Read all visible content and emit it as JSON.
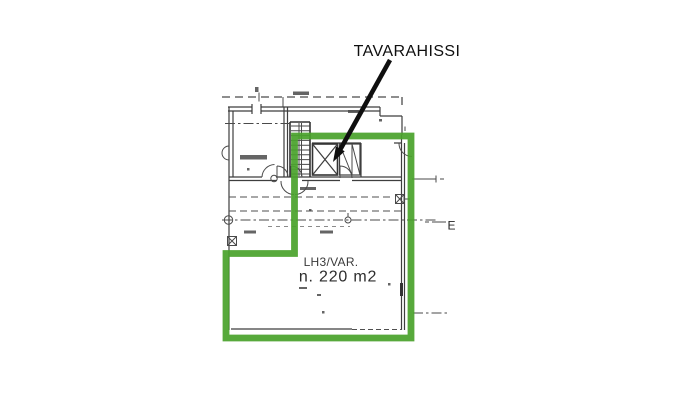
{
  "annotation": {
    "label": "TAVARAHISSI"
  },
  "area": {
    "name": "LH3/VAR.",
    "size": "n. 220 m2"
  },
  "plan": {
    "section_marker": "E"
  },
  "colors": {
    "bg": "#ffffff",
    "ink": "#3e3e3e",
    "highlight": "#4aa22c",
    "annotation": "#0f0f0f"
  }
}
